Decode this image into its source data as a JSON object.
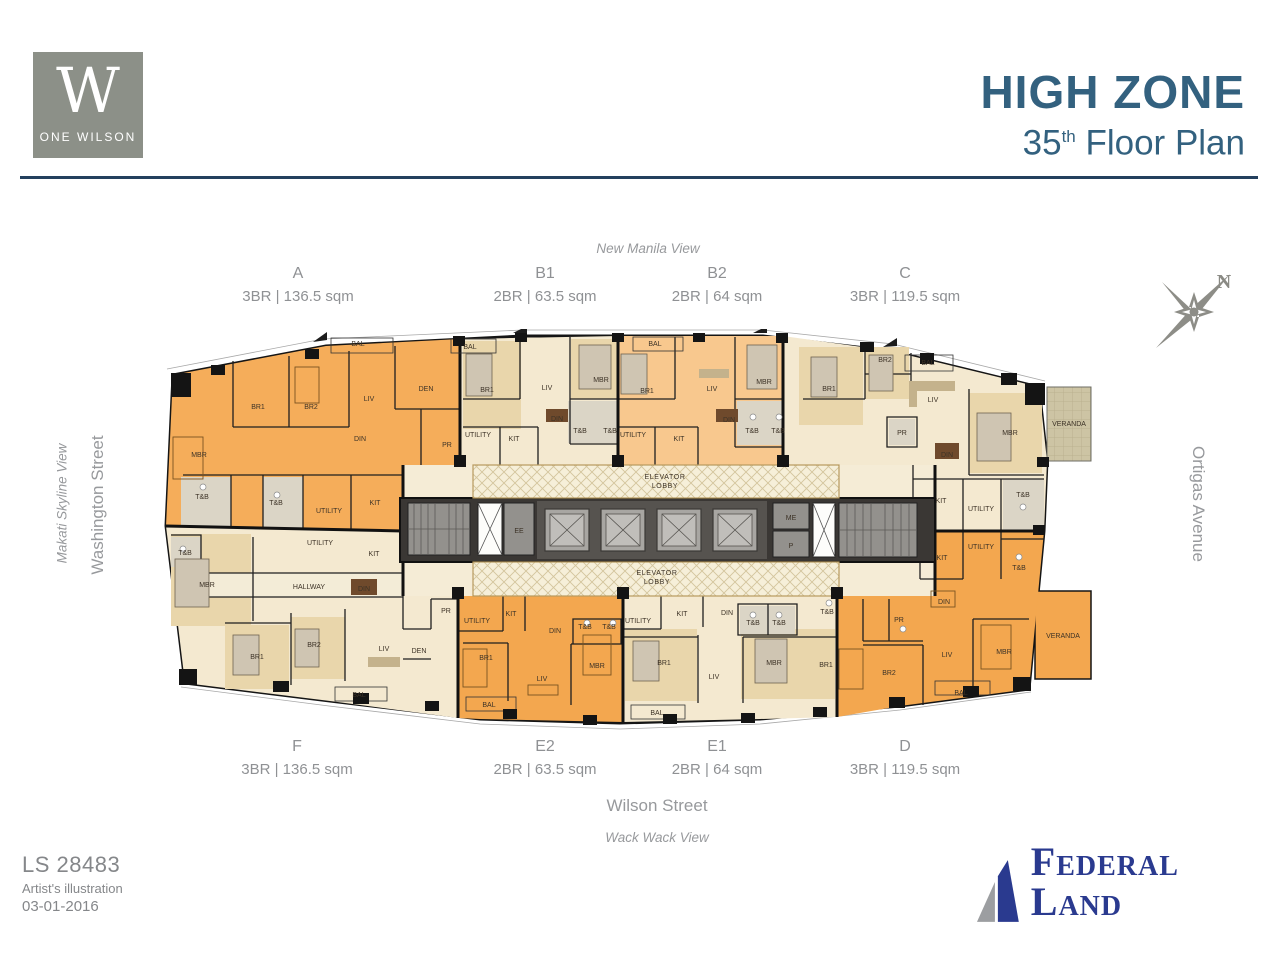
{
  "header": {
    "logo_letter": "W",
    "logo_name": "ONE WILSON",
    "title": "HIGH ZONE",
    "floor_num": "35",
    "floor_sup": "th",
    "floor_rest": " Floor Plan"
  },
  "orientation": {
    "compass_n": "N"
  },
  "surroundings": {
    "top_view": "New Manila View",
    "left_view": "Makati Skyline View",
    "left_street": "Washington Street",
    "right_street": "Ortigas Avenue",
    "bottom_street": "Wilson Street",
    "bottom_view": "Wack Wack View"
  },
  "units_top": [
    {
      "id": "A",
      "spec": "3BR | 136.5 sqm"
    },
    {
      "id": "B1",
      "spec": "2BR | 63.5 sqm"
    },
    {
      "id": "B2",
      "spec": "2BR | 64 sqm"
    },
    {
      "id": "C",
      "spec": "3BR | 119.5 sqm"
    }
  ],
  "units_bottom": [
    {
      "id": "F",
      "spec": "3BR | 136.5 sqm"
    },
    {
      "id": "E2",
      "spec": "2BR | 63.5 sqm"
    },
    {
      "id": "E1",
      "spec": "2BR | 64 sqm"
    },
    {
      "id": "D",
      "spec": "3BR | 119.5 sqm"
    }
  ],
  "footer": {
    "ref": "LS 28483",
    "note": "Artist's illustration",
    "date": "03-01-2016",
    "brand": "Federal Land"
  },
  "colors": {
    "accent_blue": "#33617f",
    "brand_navy": "#2a3a8f",
    "unit_orange": "#f3a74f",
    "unit_orange_light": "#f8c88e",
    "unit_cream": "#f4e9d0",
    "logo_gray": "#8c9088"
  },
  "floorplan": {
    "rooms": [
      {
        "t": "BAL",
        "x": 195,
        "y": 17,
        "s": 6.2
      },
      {
        "t": "DEN",
        "x": 263,
        "y": 62
      },
      {
        "t": "BR1",
        "x": 95,
        "y": 80
      },
      {
        "t": "BR2",
        "x": 148,
        "y": 80
      },
      {
        "t": "LIV",
        "x": 206,
        "y": 72
      },
      {
        "t": "DIN",
        "x": 197,
        "y": 112
      },
      {
        "t": "MBR",
        "x": 36,
        "y": 128
      },
      {
        "t": "PR",
        "x": 284,
        "y": 118,
        "s": 6.2
      },
      {
        "t": "T&B",
        "x": 39,
        "y": 170,
        "s": 6.2
      },
      {
        "t": "T&B",
        "x": 113,
        "y": 176,
        "s": 6.2
      },
      {
        "t": "UTILITY",
        "x": 166,
        "y": 184,
        "s": 6.2
      },
      {
        "t": "KIT",
        "x": 212,
        "y": 176
      },
      {
        "t": "BAL",
        "x": 307,
        "y": 20,
        "s": 6.2
      },
      {
        "t": "BR1",
        "x": 324,
        "y": 63
      },
      {
        "t": "LIV",
        "x": 384,
        "y": 61
      },
      {
        "t": "MBR",
        "x": 438,
        "y": 53
      },
      {
        "t": "DIN",
        "x": 394,
        "y": 92,
        "s": 6.2
      },
      {
        "t": "T&B",
        "x": 417,
        "y": 104,
        "s": 6.2
      },
      {
        "t": "T&B",
        "x": 447,
        "y": 104,
        "s": 6.2
      },
      {
        "t": "UTILITY",
        "x": 315,
        "y": 108,
        "s": 6.2
      },
      {
        "t": "KIT",
        "x": 351,
        "y": 112
      },
      {
        "t": "BAL",
        "x": 492,
        "y": 17,
        "s": 6.2
      },
      {
        "t": "BR1",
        "x": 484,
        "y": 64
      },
      {
        "t": "LIV",
        "x": 549,
        "y": 62
      },
      {
        "t": "MBR",
        "x": 601,
        "y": 55
      },
      {
        "t": "DIN",
        "x": 566,
        "y": 93,
        "s": 6.2
      },
      {
        "t": "T&B",
        "x": 589,
        "y": 104,
        "s": 6.2
      },
      {
        "t": "T&B",
        "x": 615,
        "y": 104,
        "s": 6.2
      },
      {
        "t": "UTILITY",
        "x": 470,
        "y": 108,
        "s": 6.2
      },
      {
        "t": "KIT",
        "x": 516,
        "y": 112
      },
      {
        "t": "BR2",
        "x": 722,
        "y": 33
      },
      {
        "t": "BAL",
        "x": 765,
        "y": 36,
        "s": 6.2
      },
      {
        "t": "BR1",
        "x": 666,
        "y": 62
      },
      {
        "t": "LIV",
        "x": 770,
        "y": 73
      },
      {
        "t": "PR",
        "x": 739,
        "y": 106,
        "s": 6.2
      },
      {
        "t": "MBR",
        "x": 847,
        "y": 106
      },
      {
        "t": "DIN",
        "x": 784,
        "y": 128
      },
      {
        "t": "KIT",
        "x": 778,
        "y": 174
      },
      {
        "t": "UTILITY",
        "x": 818,
        "y": 182,
        "s": 6.2
      },
      {
        "t": "T&B",
        "x": 860,
        "y": 168,
        "s": 6.2
      },
      {
        "t": "VERANDA",
        "x": 906,
        "y": 97,
        "s": 6.2
      },
      {
        "t": "ELEVATOR",
        "x": 502,
        "y": 150,
        "s": 6.5,
        "ls": 0.6
      },
      {
        "t": "LOBBY",
        "x": 502,
        "y": 159,
        "s": 6.5,
        "ls": 0.6
      },
      {
        "t": "ELEVATOR",
        "x": 494,
        "y": 246,
        "s": 6.5,
        "ls": 0.6
      },
      {
        "t": "LOBBY",
        "x": 494,
        "y": 255,
        "s": 6.5,
        "ls": 0.6
      },
      {
        "t": "EE",
        "x": 356,
        "y": 204,
        "s": 6.2
      },
      {
        "t": "ME",
        "x": 628,
        "y": 191,
        "s": 6.2
      },
      {
        "t": "P",
        "x": 628,
        "y": 219,
        "s": 6.2
      },
      {
        "t": "T&B",
        "x": 22,
        "y": 226,
        "s": 6.2
      },
      {
        "t": "UTILITY",
        "x": 157,
        "y": 216,
        "s": 6.2
      },
      {
        "t": "KIT",
        "x": 211,
        "y": 227
      },
      {
        "t": "MBR",
        "x": 44,
        "y": 258
      },
      {
        "t": "HALLWAY",
        "x": 146,
        "y": 260,
        "s": 6.5
      },
      {
        "t": "DIN",
        "x": 201,
        "y": 262
      },
      {
        "t": "BR1",
        "x": 94,
        "y": 330
      },
      {
        "t": "BR2",
        "x": 151,
        "y": 318
      },
      {
        "t": "LIV",
        "x": 221,
        "y": 322
      },
      {
        "t": "DEN",
        "x": 256,
        "y": 324
      },
      {
        "t": "PR",
        "x": 283,
        "y": 284,
        "s": 6.2
      },
      {
        "t": "BAL",
        "x": 196,
        "y": 368,
        "s": 6.2
      },
      {
        "t": "UTILITY",
        "x": 314,
        "y": 294,
        "s": 6.2
      },
      {
        "t": "KIT",
        "x": 348,
        "y": 287
      },
      {
        "t": "DIN",
        "x": 392,
        "y": 304
      },
      {
        "t": "T&B",
        "x": 422,
        "y": 300,
        "s": 6.2
      },
      {
        "t": "T&B",
        "x": 446,
        "y": 300,
        "s": 6.2
      },
      {
        "t": "BR1",
        "x": 323,
        "y": 331
      },
      {
        "t": "LIV",
        "x": 379,
        "y": 352
      },
      {
        "t": "MBR",
        "x": 434,
        "y": 339
      },
      {
        "t": "BAL",
        "x": 326,
        "y": 378,
        "s": 6.2
      },
      {
        "t": "UTILITY",
        "x": 475,
        "y": 294,
        "s": 6.2
      },
      {
        "t": "KIT",
        "x": 519,
        "y": 287
      },
      {
        "t": "DIN",
        "x": 564,
        "y": 286
      },
      {
        "t": "T&B",
        "x": 590,
        "y": 296,
        "s": 6.2
      },
      {
        "t": "T&B",
        "x": 616,
        "y": 296,
        "s": 6.2
      },
      {
        "t": "BR1",
        "x": 501,
        "y": 336
      },
      {
        "t": "LIV",
        "x": 551,
        "y": 350
      },
      {
        "t": "MBR",
        "x": 611,
        "y": 336
      },
      {
        "t": "BAL",
        "x": 494,
        "y": 386,
        "s": 6.2
      },
      {
        "t": "UTILITY",
        "x": 818,
        "y": 220,
        "s": 6.2
      },
      {
        "t": "T&B",
        "x": 856,
        "y": 241,
        "s": 6.2
      },
      {
        "t": "KIT",
        "x": 779,
        "y": 231
      },
      {
        "t": "DIN",
        "x": 781,
        "y": 275
      },
      {
        "t": "T&B",
        "x": 664,
        "y": 285,
        "s": 6.2
      },
      {
        "t": "PR",
        "x": 736,
        "y": 293,
        "s": 6.2
      },
      {
        "t": "BR1",
        "x": 663,
        "y": 338
      },
      {
        "t": "BR2",
        "x": 726,
        "y": 346
      },
      {
        "t": "LIV",
        "x": 784,
        "y": 328
      },
      {
        "t": "MBR",
        "x": 841,
        "y": 325
      },
      {
        "t": "BAL",
        "x": 798,
        "y": 366,
        "s": 6.2
      },
      {
        "t": "VERANDA",
        "x": 900,
        "y": 309,
        "s": 6.2
      }
    ]
  }
}
